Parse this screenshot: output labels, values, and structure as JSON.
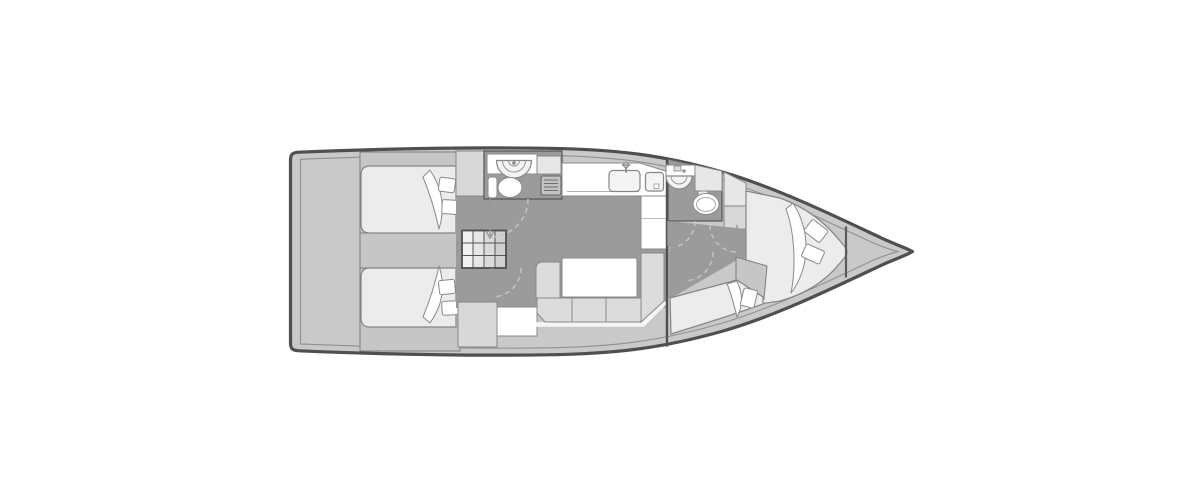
{
  "vessel": {
    "label": "Sailing yacht interior layout floor plan, bow pointing right",
    "type": "monohull-sailboat-deck-plan",
    "orientation": "bow-right"
  },
  "palette": {
    "page_bg": "#ffffff",
    "hull_outline": "#4f4f4f",
    "hull_fill": "#c9c9c9",
    "inner_line": "#909090",
    "wall_grey": "#c6c6c6",
    "floor_grey": "#9b9b9b",
    "furniture_grey": "#dcdcdc",
    "cabinet_grey": "#d8d8d8",
    "cabinet_light": "#e7e7e7",
    "mattress_grey": "#ececec",
    "fixture_fill": "#f4f4f4",
    "pure_white": "#ffffff",
    "door_arc_grey": "#c4c4c4"
  },
  "rooms": [
    {
      "id": "stern-locker",
      "name": "transom / lazarette"
    },
    {
      "id": "aft-cabin-port",
      "name": "aft double cabin (top)",
      "furniture": [
        "double-berth",
        "blanket",
        "pillows",
        "wardrobe"
      ]
    },
    {
      "id": "aft-cabin-starboard",
      "name": "aft double cabin (bottom)",
      "furniture": [
        "double-berth",
        "blanket",
        "pillows",
        "cabinet",
        "vanity"
      ]
    },
    {
      "id": "aft-head",
      "name": "aft bathroom",
      "fixtures": [
        "round-shower-sink",
        "toilet",
        "vent-grate",
        "counter"
      ]
    },
    {
      "id": "galley",
      "name": "galley",
      "fixtures": [
        "double-sink",
        "faucet",
        "l-shaped-counter"
      ]
    },
    {
      "id": "salon",
      "name": "salon",
      "furniture": [
        "companionway-stairs",
        "u-settee",
        "dining-table"
      ]
    },
    {
      "id": "fwd-head",
      "name": "forward bathroom",
      "fixtures": [
        "washbasin",
        "toilet",
        "cabinets"
      ]
    },
    {
      "id": "fwd-cabin",
      "name": "forward owner cabin",
      "furniture": [
        "v-berth",
        "blanket",
        "pillows",
        "chaise-seat"
      ]
    },
    {
      "id": "bow-locker",
      "name": "anchor locker"
    }
  ],
  "doors": [
    "aft-head-door",
    "aft-cabin-door",
    "fwd-head-door",
    "fwd-cabin-door",
    "fwd-locker-door"
  ]
}
